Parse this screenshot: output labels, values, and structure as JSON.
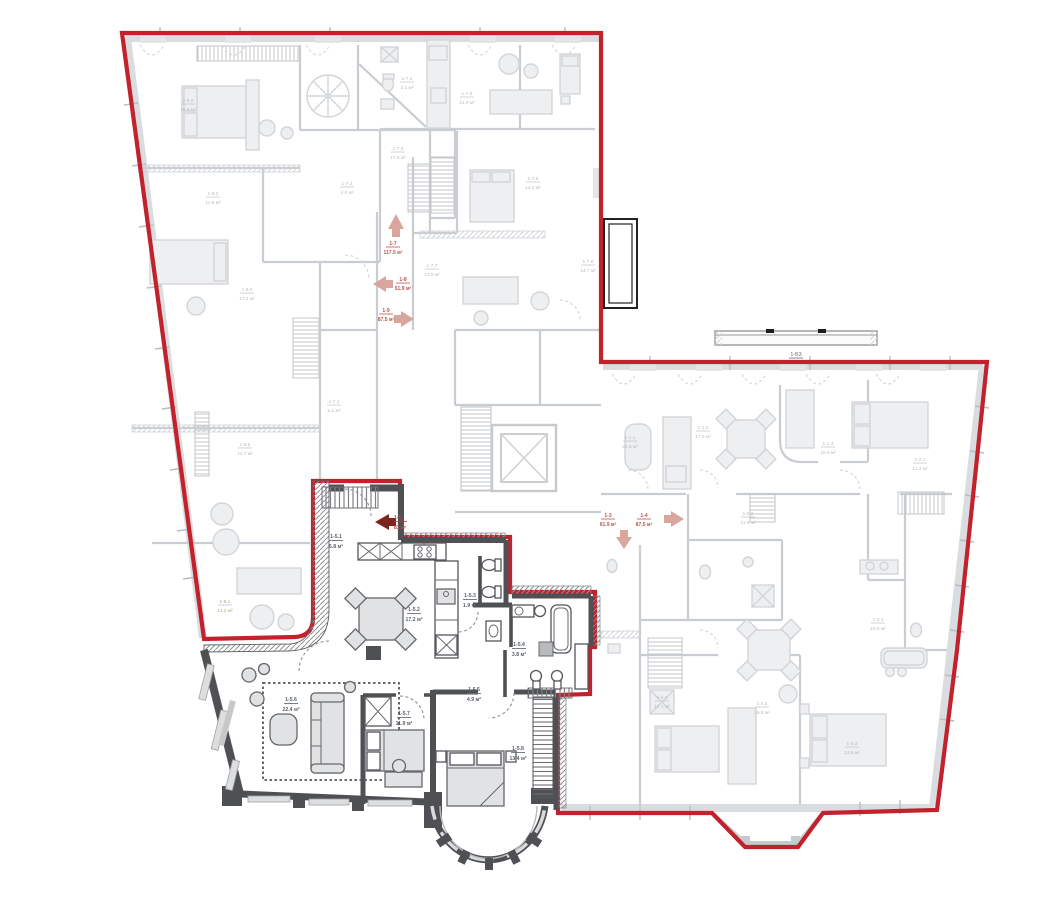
{
  "colors": {
    "outline_red": "#c2222b",
    "arrow_dark_red": "#7c241d",
    "arrow_faded": "#d9a69d",
    "label_red": "#b5453b",
    "wall_dark": "#4f5054"
  },
  "apartment": {
    "unit_id": "1-5",
    "unit_area": "81 м²",
    "rooms": [
      {
        "id": "1-5.1",
        "area": "5.8 м²"
      },
      {
        "id": "1-5.2",
        "area": "17.2 м²"
      },
      {
        "id": "1-5.3",
        "area": "1.9 м²"
      },
      {
        "id": "1-5.4",
        "area": "3.8 м²"
      },
      {
        "id": "1-5.5",
        "area": "4.9 м²"
      },
      {
        "id": "1-5.6",
        "area": "22.4 м²"
      },
      {
        "id": "1-5.7",
        "area": "11.9 м²"
      },
      {
        "id": "1-5.8",
        "area": "13.4 м²"
      }
    ]
  },
  "corridor_arrows": [
    {
      "id": "1-7",
      "area": "117.5 м²"
    },
    {
      "id": "1-8",
      "area": "51.9 м²"
    },
    {
      "id": "1-9",
      "area": "87.5 м²"
    },
    {
      "id": "1-3",
      "area": "61.9 м²"
    },
    {
      "id": "1-4",
      "area": "87.5 м²"
    }
  ],
  "balcony": {
    "id": "1-Б3"
  },
  "faded_labels": [
    {
      "id": "1-6.2",
      "area": "16.9 м²"
    },
    {
      "id": "1-6.3",
      "area": "11.8 м²"
    },
    {
      "id": "1-6.4",
      "area": "17.4 м²"
    },
    {
      "id": "1-6.5",
      "area": "11.7 м²"
    },
    {
      "id": "1-6.1",
      "area": "11.2 м²"
    },
    {
      "id": "1-7.1",
      "area": "5.1 м²"
    },
    {
      "id": "1-7.2",
      "area": "4.6 м²"
    },
    {
      "id": "1-7.3",
      "area": "17.6 м²"
    },
    {
      "id": "1-7.4",
      "area": "3.1 м²"
    },
    {
      "id": "1-7.5",
      "area": "21.9 м²"
    },
    {
      "id": "1-7.6",
      "area": "14.2 м²"
    },
    {
      "id": "1-7.7",
      "area": "13.9 м²"
    },
    {
      "id": "1-7.8",
      "area": "14.7 м²"
    },
    {
      "id": "1-1.1",
      "area": "21.6 м²"
    },
    {
      "id": "1-1.2",
      "area": "17.5 м²"
    },
    {
      "id": "1-1.3",
      "area": "15.4 м²"
    },
    {
      "id": "1-2.1",
      "area": "11.4 м²"
    },
    {
      "id": "1-2.2",
      "area": "21.9 м²"
    },
    {
      "id": "1-3.1",
      "area": "16.5 м²"
    },
    {
      "id": "1-4.1",
      "area": "17.1 м²"
    },
    {
      "id": "1-4.2",
      "area": "16.8 м²"
    },
    {
      "id": "1-4.3",
      "area": "13.6 м²"
    }
  ]
}
